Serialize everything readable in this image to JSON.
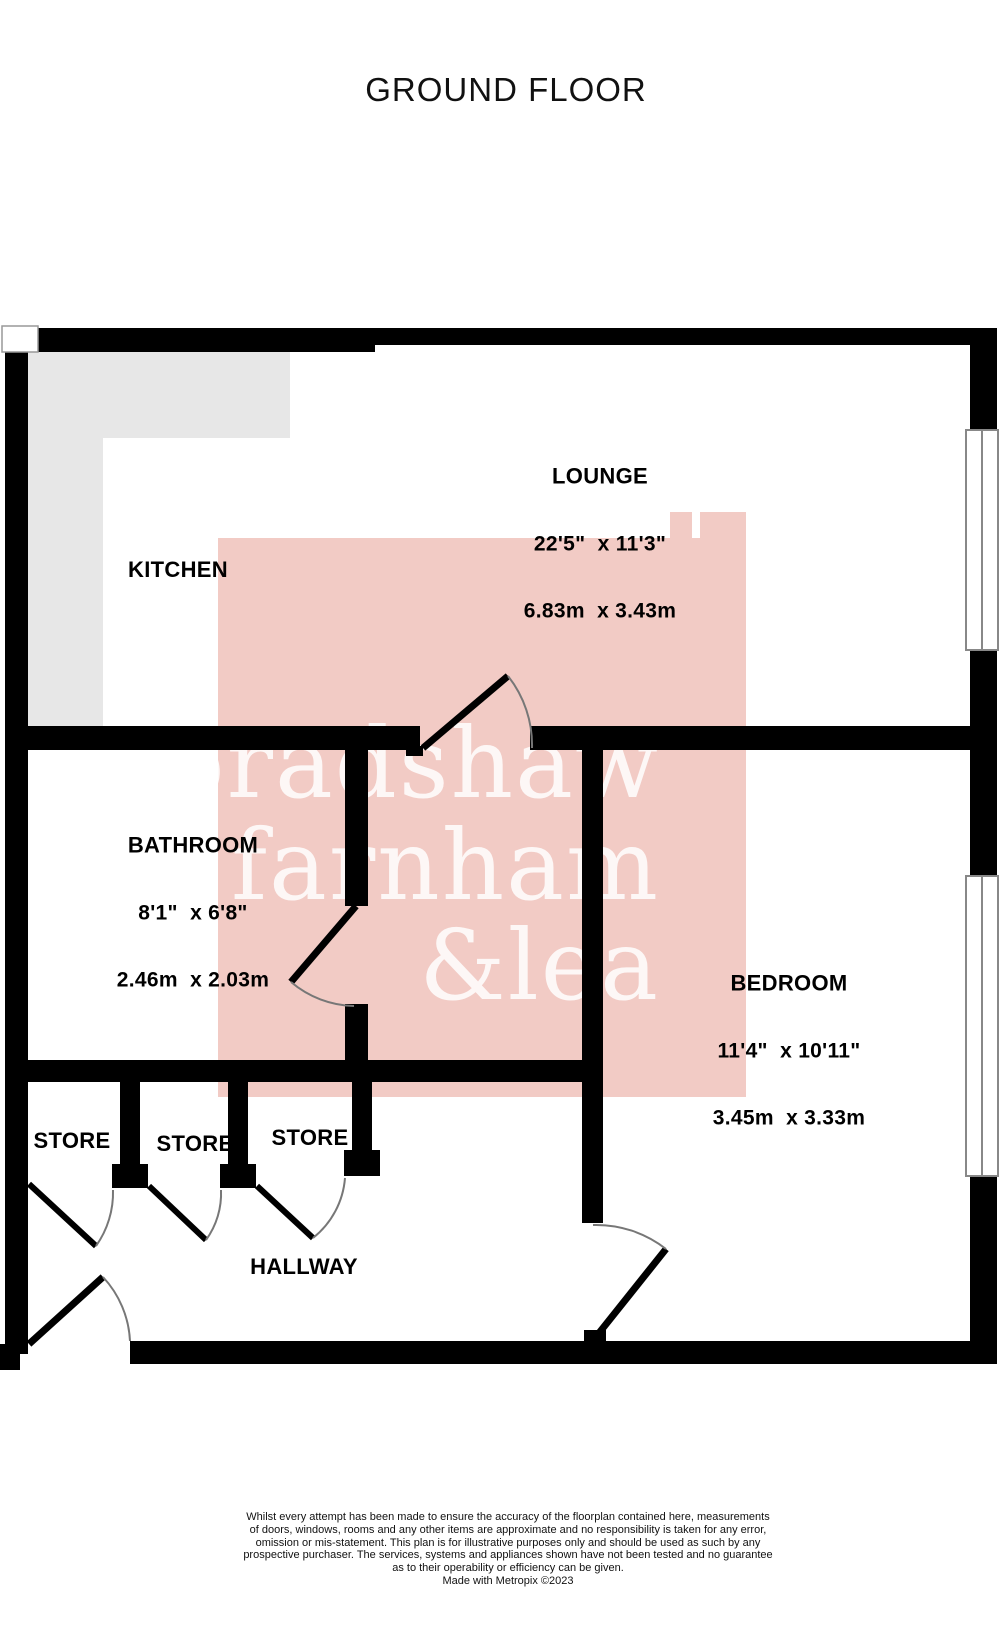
{
  "title": "GROUND FLOOR",
  "watermark": {
    "line1": "bradshaw",
    "line2": "farnham",
    "line3": "&lea"
  },
  "rooms": {
    "kitchen": {
      "name": "KITCHEN"
    },
    "lounge": {
      "name": "LOUNGE",
      "imperial": "22'5\"  x 11'3\"",
      "metric": "6.83m  x 3.43m"
    },
    "bathroom": {
      "name": "BATHROOM",
      "imperial": "8'1\"  x 6'8\"",
      "metric": "2.46m  x 2.03m"
    },
    "bedroom": {
      "name": "BEDROOM",
      "imperial": "11'4\"  x 10'11\"",
      "metric": "3.45m  x 3.33m"
    },
    "store1": {
      "name": "STORE"
    },
    "store2": {
      "name": "STORE"
    },
    "store3": {
      "name": "STORE"
    },
    "hallway": {
      "name": "HALLWAY"
    }
  },
  "colors": {
    "wall": "#000000",
    "kitchen_counter": "#e7e7e7",
    "watermark_pink": "#f2cbc5",
    "door_arc": "#777777",
    "window_frame": "#888888"
  },
  "footer": {
    "lines": [
      "Whilst every attempt has been made to ensure the accuracy of the floorplan contained here, measurements",
      "of doors, windows, rooms and any other items are approximate and no responsibility is taken for any error,",
      "omission or mis-statement. This plan is for illustrative purposes only and should be used as such by any",
      "prospective purchaser. The services, systems and appliances shown have not been tested and no guarantee",
      "as to their operability or efficiency can be given."
    ],
    "credit": "Made with Metropix ©2023"
  }
}
